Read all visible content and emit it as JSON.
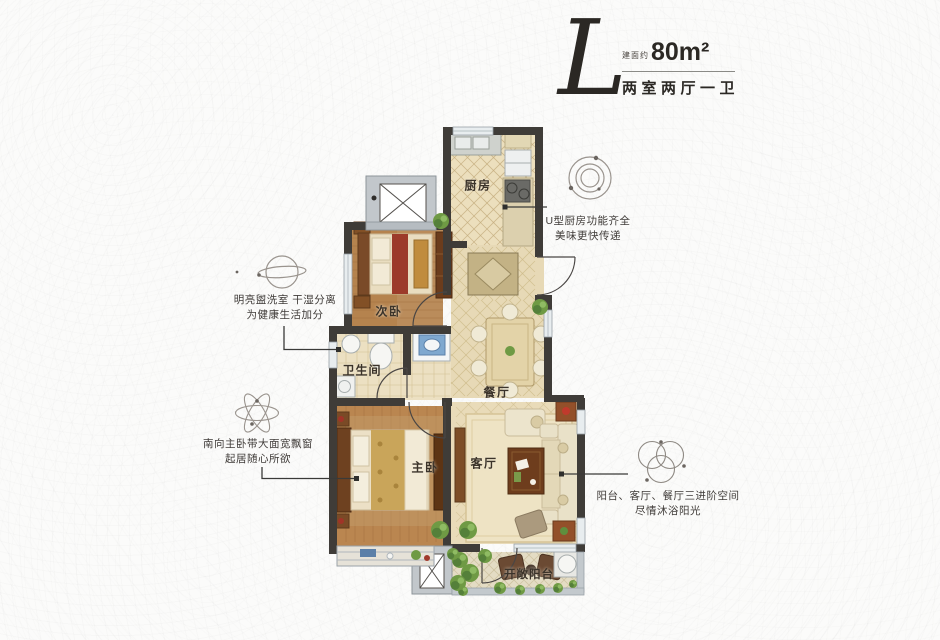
{
  "header": {
    "plan_letter": "L",
    "area_prefix": "建面约",
    "area_value": "80m²",
    "layout_text": "两室两厅一卫"
  },
  "rooms": {
    "kitchen": "厨房",
    "second_bedroom": "次卧",
    "bathroom": "卫生间",
    "dining": "餐厅",
    "master_bedroom": "主卧",
    "living": "客厅",
    "balcony": "开敞阳台"
  },
  "annotations": {
    "kitchen": {
      "line1": "U型厨房功能齐全",
      "line2": "美味更快传递"
    },
    "washroom": {
      "line1": "明亮盥洗室 干湿分离",
      "line2": "为健康生活加分"
    },
    "master": {
      "line1": "南向主卧带大面宽飘窗",
      "line2": "起居随心所欲"
    },
    "sunlight": {
      "line1": "阳台、客厅、餐厅三进阶空间",
      "line2": "尽情沐浴阳光"
    }
  },
  "colors": {
    "wall": "#3f3c38",
    "wood_floor": "#b9854e",
    "tile_floor": "#e7d9b6",
    "accent_red": "#9c3a2a",
    "plant_green": "#6f9a44",
    "note_text": "#3f3b38"
  }
}
